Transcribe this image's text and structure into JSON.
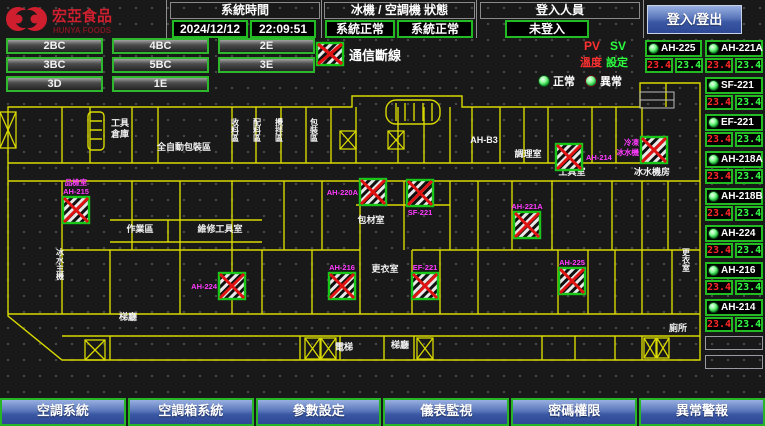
{
  "header": {
    "brand": {
      "name": "宏亞食品",
      "sub": "HUNYA FOODS"
    },
    "system_time": {
      "label": "系統時間",
      "date": "2024/12/12",
      "time": "22:09:51"
    },
    "machine_status": {
      "label": "冰機 / 空調機 狀態",
      "chiller": "系統正常",
      "ahu": "系統正常"
    },
    "login": {
      "label": "登入人員",
      "status": "未登入",
      "button_label": "登入/登出"
    }
  },
  "floor_nav": {
    "buttons": [
      {
        "key": "2bc",
        "label": "2BC"
      },
      {
        "key": "4bc",
        "label": "4BC"
      },
      {
        "key": "2e",
        "label": "2E"
      },
      {
        "key": "3bc",
        "label": "3BC"
      },
      {
        "key": "5bc",
        "label": "5BC"
      },
      {
        "key": "3e",
        "label": "3E"
      },
      {
        "key": "3d",
        "label": "3D"
      },
      {
        "key": "1e",
        "label": "1E"
      }
    ]
  },
  "legend": {
    "comm_offline": "通信斷線",
    "pv": "PV",
    "sv": "SV",
    "pv_sub": "溫度",
    "sv_sub": "設定",
    "normal": "正常",
    "abnormal": "異常"
  },
  "equipment": {
    "column_a": [
      {
        "key": "ah-225",
        "name": "AH-225",
        "pv": "23.4",
        "sv": "23.4",
        "status": "normal"
      }
    ],
    "column_b": [
      {
        "key": "ah-221a",
        "name": "AH-221A",
        "pv": "23.4",
        "sv": "23.4",
        "status": "normal"
      },
      {
        "key": "sf-221",
        "name": "SF-221",
        "pv": "23.4",
        "sv": "23.4",
        "status": "normal"
      },
      {
        "key": "ef-221",
        "name": "EF-221",
        "pv": "23.4",
        "sv": "23.4",
        "status": "normal"
      },
      {
        "key": "ah-218a",
        "name": "AH-218A",
        "pv": "23.4",
        "sv": "23.4",
        "status": "normal"
      },
      {
        "key": "ah-218b",
        "name": "AH-218B",
        "pv": "23.4",
        "sv": "23.4",
        "status": "normal"
      },
      {
        "key": "ah-224",
        "name": "AH-224",
        "pv": "23.4",
        "sv": "23.4",
        "status": "normal"
      },
      {
        "key": "ah-216",
        "name": "AH-216",
        "pv": "23.4",
        "sv": "23.4",
        "status": "normal"
      },
      {
        "key": "ah-214",
        "name": "AH-214",
        "pv": "23.4",
        "sv": "23.4",
        "status": "normal"
      }
    ],
    "empty_slots": 2
  },
  "map": {
    "rooms": [
      {
        "t": "工具",
        "x": 120,
        "y": 126
      },
      {
        "t": "倉庫",
        "x": 120,
        "y": 137
      },
      {
        "t": "全自動包裝區",
        "x": 184,
        "y": 150
      },
      {
        "t": "收料區",
        "x": 235,
        "y": 118,
        "v": 1
      },
      {
        "t": "配料區",
        "x": 257,
        "y": 118,
        "v": 1
      },
      {
        "t": "攪拌區",
        "x": 279,
        "y": 118,
        "v": 1
      },
      {
        "t": "包裝區",
        "x": 314,
        "y": 118,
        "v": 1
      },
      {
        "t": "AH-B3",
        "x": 484,
        "y": 143
      },
      {
        "t": "調理室",
        "x": 528,
        "y": 157
      },
      {
        "t": "工具室",
        "x": 572,
        "y": 175
      },
      {
        "t": "冰水機房",
        "x": 652,
        "y": 175
      },
      {
        "t": "包材室",
        "x": 371,
        "y": 223
      },
      {
        "t": "作業區",
        "x": 140,
        "y": 232
      },
      {
        "t": "維修工具室",
        "x": 220,
        "y": 232
      },
      {
        "t": "更衣室",
        "x": 385,
        "y": 272
      },
      {
        "t": "冰水主機",
        "x": 60,
        "y": 248,
        "v": 1
      },
      {
        "t": "梯廳",
        "x": 128,
        "y": 320
      },
      {
        "t": "梯廳",
        "x": 400,
        "y": 348
      },
      {
        "t": "電梯",
        "x": 344,
        "y": 350
      },
      {
        "t": "更衣室",
        "x": 686,
        "y": 248,
        "v": 1
      },
      {
        "t": "廁所",
        "x": 678,
        "y": 331
      }
    ],
    "devices": [
      {
        "key": "ah-215",
        "lines": [
          "品檢室",
          "AH-215"
        ],
        "x": 63,
        "y": 197,
        "pos": "above"
      },
      {
        "key": "ah-220a",
        "lines": [
          "AH-220A"
        ],
        "x": 360,
        "y": 179,
        "pos": "left"
      },
      {
        "key": "sf-221",
        "lines": [
          "SF-221"
        ],
        "x": 407,
        "y": 180,
        "pos": "below"
      },
      {
        "key": "ah-221a",
        "lines": [
          "AH-221A"
        ],
        "x": 514,
        "y": 212,
        "pos": "above"
      },
      {
        "key": "ah-216",
        "lines": [
          "AH-216"
        ],
        "x": 329,
        "y": 273,
        "pos": "above"
      },
      {
        "key": "ef-221",
        "lines": [
          "EF-221"
        ],
        "x": 412,
        "y": 273,
        "pos": "above"
      },
      {
        "key": "ah-224",
        "lines": [
          "AH-224"
        ],
        "x": 219,
        "y": 273,
        "pos": "left"
      },
      {
        "key": "ah-225",
        "lines": [
          "AH-225"
        ],
        "x": 559,
        "y": 268,
        "pos": "above"
      },
      {
        "key": "ah-214",
        "lines": [
          "AH-214"
        ],
        "x": 556,
        "y": 144,
        "pos": "right"
      },
      {
        "key": "freezer-chiller",
        "lines": [
          "冷凍",
          "冰水機"
        ],
        "x": 641,
        "y": 137,
        "pos": "left"
      }
    ]
  },
  "footer": {
    "buttons": [
      {
        "key": "ac-system",
        "label": "空調系統"
      },
      {
        "key": "ahu-system",
        "label": "空調箱系統"
      },
      {
        "key": "parameter-setting",
        "label": "參數設定"
      },
      {
        "key": "meter-monitor",
        "label": "儀表監視"
      },
      {
        "key": "password-permission",
        "label": "密碼權限"
      },
      {
        "key": "abnormal-alarm",
        "label": "異常警報"
      }
    ]
  },
  "colors": {
    "accent_green": "#22bb22",
    "alarm_red": "#ff2828",
    "sv_green": "#35ff46",
    "magenta": "#ff3bff",
    "wall_yellow": "#d8d800",
    "button_blue": "#3a57a3"
  }
}
